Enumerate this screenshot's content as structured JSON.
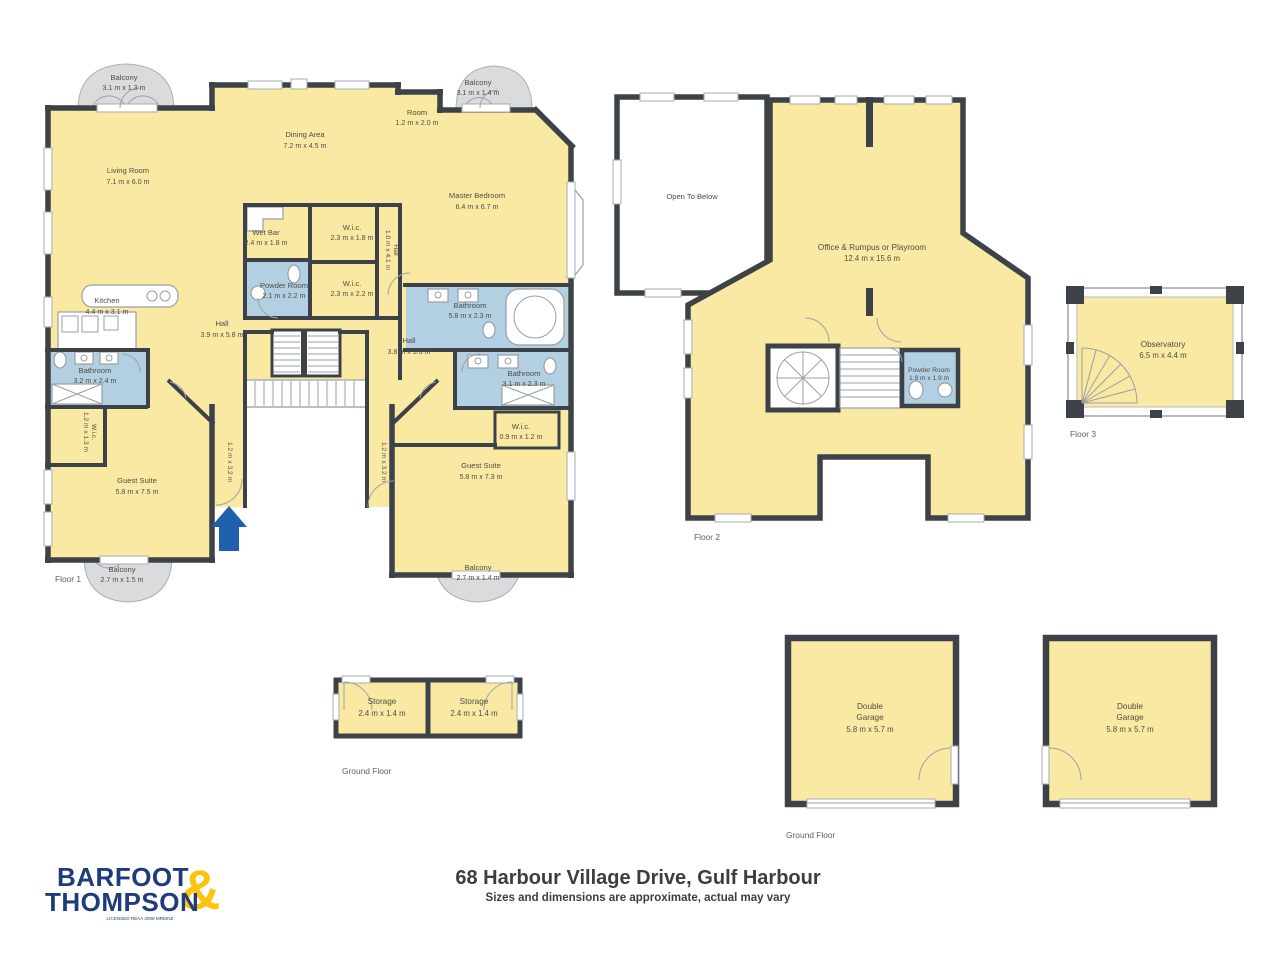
{
  "floors": {
    "floor1": {
      "label": "Floor 1",
      "rooms": {
        "balcony_tl": {
          "name": "Balcony",
          "dims": "3.1 m x 1.3 m"
        },
        "living_room": {
          "name": "Living Room",
          "dims": "7.1 m x 6.0 m"
        },
        "dining_area": {
          "name": "Dining Area",
          "dims": "7.2 m x 4.5 m"
        },
        "room_small": {
          "name": "Room",
          "dims": "1.2 m x 2.0 m"
        },
        "balcony_tr": {
          "name": "Balcony",
          "dims": "3.1 m x 1.4 m"
        },
        "master_bedroom": {
          "name": "Master Bedroom",
          "dims": "6.4 m x 6.7 m"
        },
        "wet_bar": {
          "name": "Wet Bar",
          "dims": "2.4 m x 1.8 m"
        },
        "wic_top": {
          "name": "W.i.c.",
          "dims": "2.3 m x 1.8 m"
        },
        "hall_small": {
          "name": "Hall",
          "dims": "1.0 m x 4.1 m"
        },
        "powder_room": {
          "name": "Powder Room",
          "dims": "2.1 m x 2.2 m"
        },
        "wic_mid": {
          "name": "W.i.c.",
          "dims": "2.3 m x 2.2 m"
        },
        "bathroom_master": {
          "name": "Bathroom",
          "dims": "5.8 m x 2.3 m"
        },
        "kitchen": {
          "name": "Kitchen",
          "dims": "4.4 m x 3.1 m"
        },
        "hall_main": {
          "name": "Hall",
          "dims": "3.9 m x 5.8 m"
        },
        "bathroom_left": {
          "name": "Bathroom",
          "dims": "3.2 m x 2.4 m"
        },
        "wic_left": {
          "name": "W.i.c.",
          "dims": "1.2 m x 1.3 m"
        },
        "guest_suite_left": {
          "name": "Guest Suite",
          "dims": "5.8 m x 7.5 m"
        },
        "passage_left": {
          "dims": "1.2 m x 3.2 m"
        },
        "hall_right": {
          "name": "Hall",
          "dims": "3.8 m x 3.6 m"
        },
        "bathroom_right": {
          "name": "Bathroom",
          "dims": "3.1 m x 2.3 m"
        },
        "wic_right": {
          "name": "W.i.c.",
          "dims": "0.9 m x 1.2 m"
        },
        "passage_right": {
          "dims": "1.2 m x 3.2 m"
        },
        "guest_suite_right": {
          "name": "Guest Suite",
          "dims": "5.8 m x 7.3 m"
        },
        "balcony_bl": {
          "name": "Balcony",
          "dims": "2.7 m x 1.5 m"
        },
        "balcony_br": {
          "name": "Balcony",
          "dims": "2.7 m x 1.4 m"
        }
      }
    },
    "floor2": {
      "label": "Floor 2",
      "rooms": {
        "open_to_below": {
          "name": "Open To Below"
        },
        "office": {
          "name": "Office & Rumpus or Playroom",
          "dims": "12.4 m x 15.6 m"
        },
        "powder_room": {
          "name": "Powder Room",
          "dims": "1.9 m x 1.9 m"
        }
      }
    },
    "floor3": {
      "label": "Floor 3",
      "rooms": {
        "observatory": {
          "name": "Observatory",
          "dims": "6.5 m x 4.4 m"
        }
      }
    },
    "ground_storage": {
      "label": "Ground Floor",
      "rooms": {
        "storage_1": {
          "name": "Storage",
          "dims": "2.4 m x 1.4 m"
        },
        "storage_2": {
          "name": "Storage",
          "dims": "2.4 m x 1.4 m"
        }
      }
    },
    "ground_garage": {
      "label": "Ground Floor",
      "rooms": {
        "garage_1": {
          "name_line1": "Double",
          "name_line2": "Garage",
          "dims": "5.8 m x 5.7 m"
        },
        "garage_2": {
          "name_line1": "Double",
          "name_line2": "Garage",
          "dims": "5.8 m x 5.7 m"
        }
      }
    }
  },
  "footer": {
    "title": "68 Harbour Village Drive, Gulf Harbour",
    "subtitle": "Sizes and dimensions are approximate, actual may vary",
    "brand": {
      "line1": "BARFOOT",
      "line2": "THOMPSON",
      "ampersand": "&",
      "tagline": "LICENSED REAA 2008 MREINZ"
    }
  },
  "colors": {
    "room_fill": "#FAE9A2",
    "bathroom_fill": "#B2D0E1",
    "balcony_fill": "#DADBDC",
    "wall": "#3C4247",
    "entry_arrow": "#2160AE",
    "brand_navy": "#1E3C7B",
    "brand_yellow": "#FFC20E"
  }
}
